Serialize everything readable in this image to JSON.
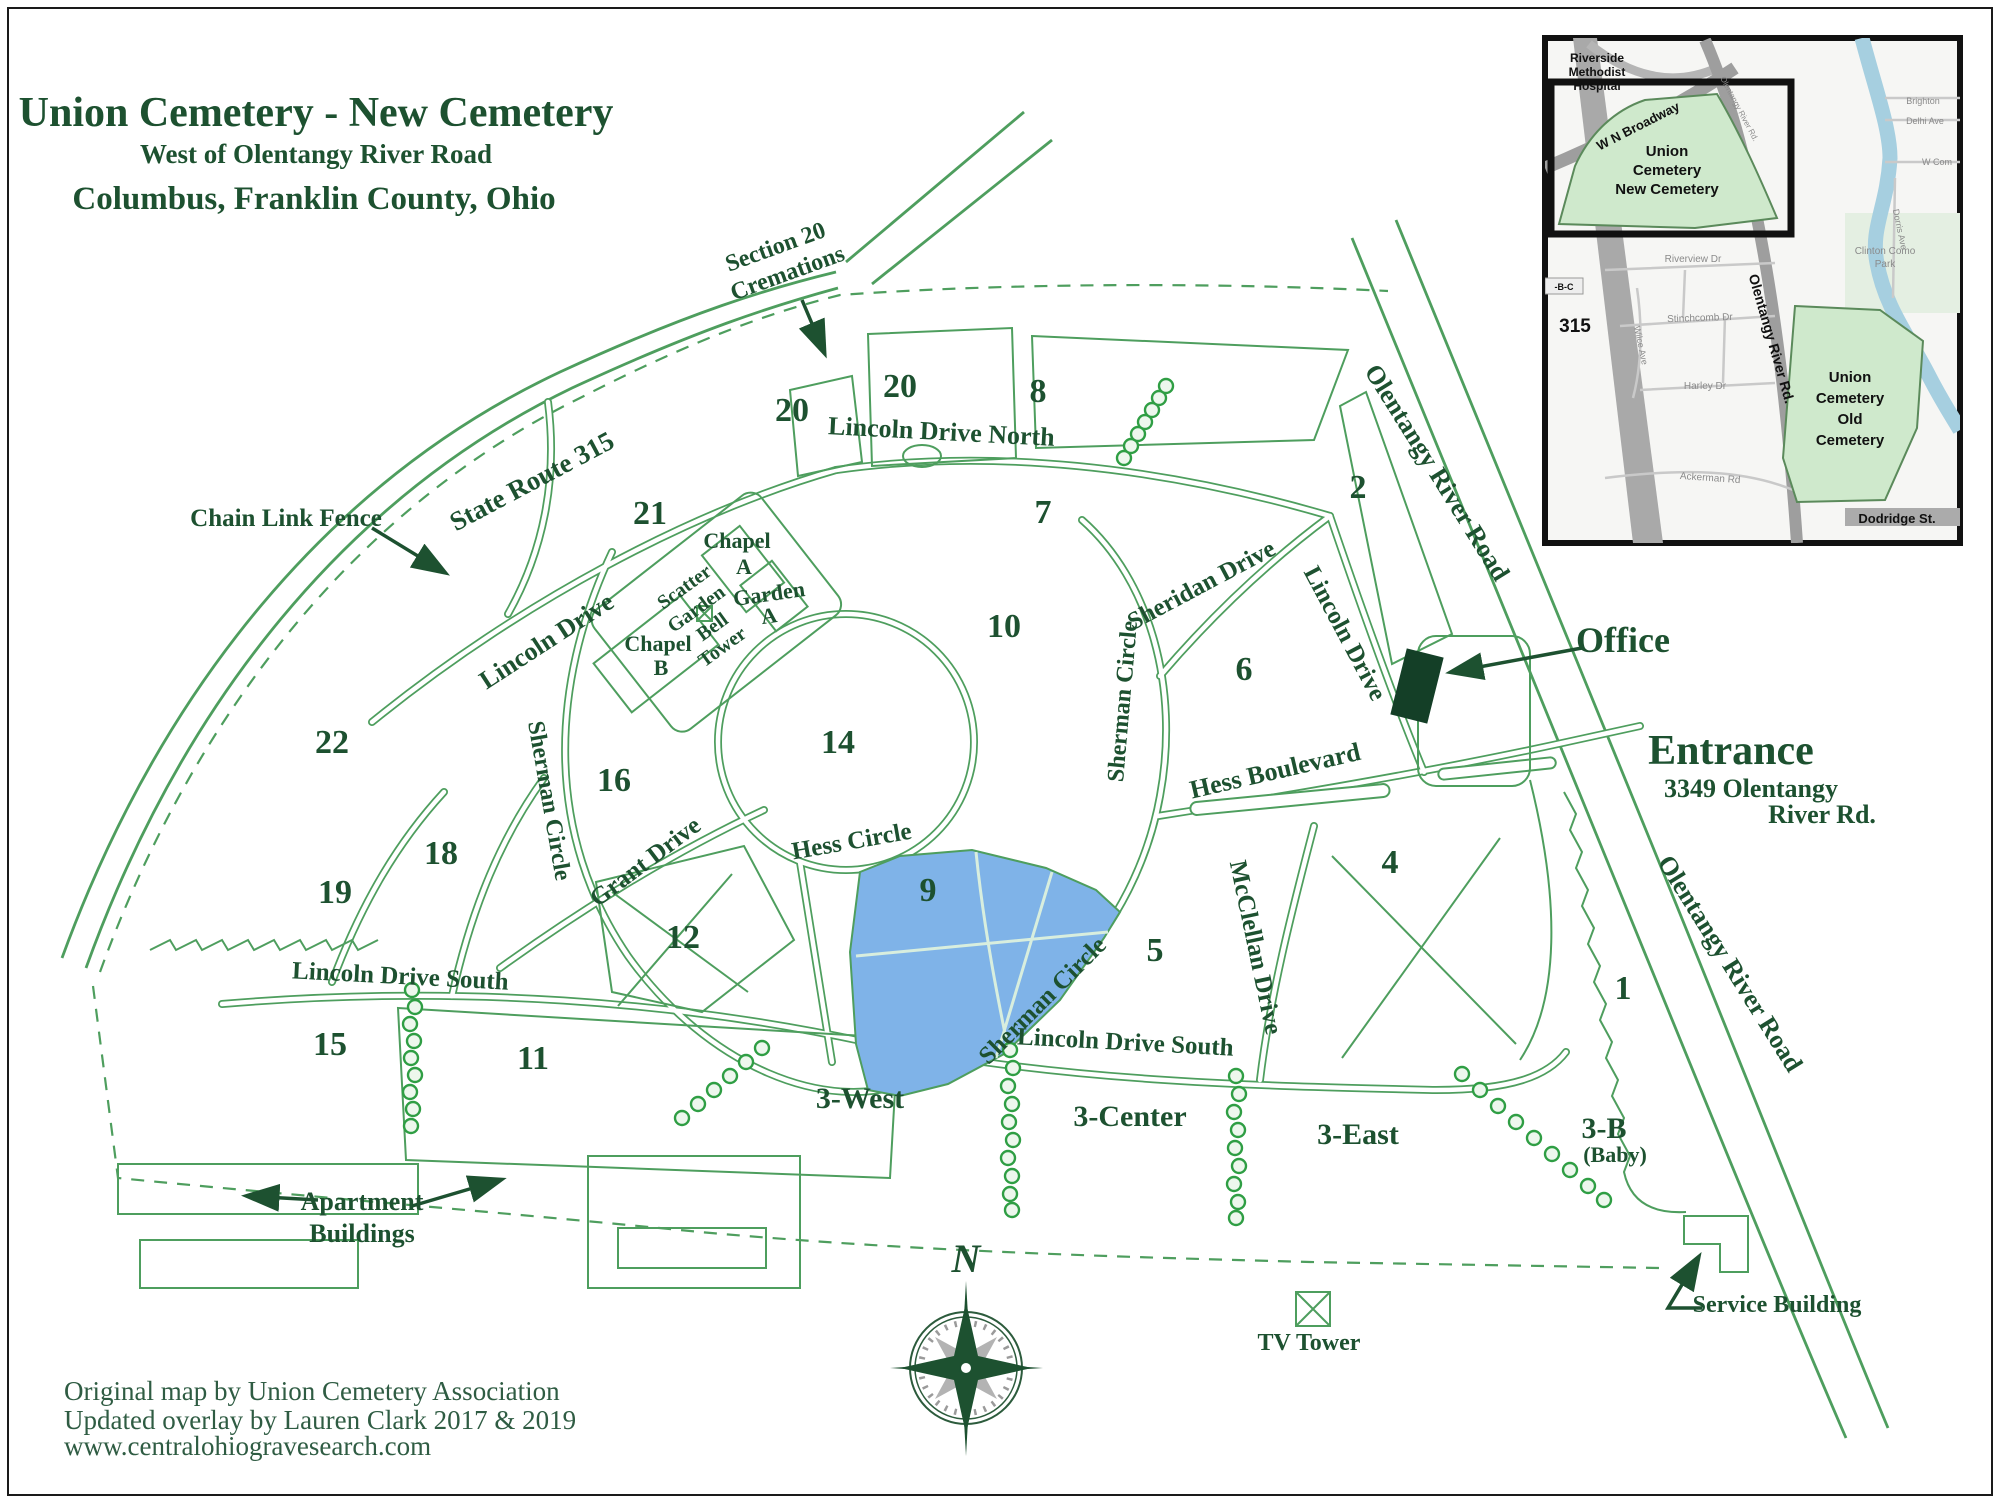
{
  "title": {
    "line1": "Union Cemetery - New Cemetery",
    "line2": "West of Olentangy River Road",
    "line3": "Columbus, Franklin County, Ohio"
  },
  "credits": {
    "line1": "Original map by Union Cemetery Association",
    "line2": "Updated overlay by Lauren Clark 2017 & 2019",
    "line3": "www.centralohiogravesearch.com"
  },
  "compass": {
    "north": "N"
  },
  "colors": {
    "road_green": "#4e9e5e",
    "label_green": "#1d5130",
    "section9_blue": "#7fb3e8",
    "tree_green": "#2f9e44",
    "office_fill": "#143f27",
    "inset_cemetery_green": "#cfe9cc",
    "inset_river_blue": "#a6cfe0"
  },
  "roads": {
    "state_route_315": "State Route 315",
    "lincoln_drive_north": "Lincoln Drive North",
    "lincoln_drive": "Lincoln Drive",
    "sheridan_drive": "Sheridan Drive",
    "sherman_circle": "Sherman Circle",
    "hess_circle": "Hess Circle",
    "hess_boulevard": "Hess Boulevard",
    "grant_drive": "Grant Drive",
    "lincoln_drive_south": "Lincoln Drive South",
    "mcclellan_drive": "McClellan Drive",
    "olentangy_river_road": "Olentangy River Road"
  },
  "sections": {
    "s1": "1",
    "s2": "2",
    "s4": "4",
    "s5": "5",
    "s6": "6",
    "s7": "7",
    "s8": "8",
    "s9": "9",
    "s10": "10",
    "s11": "11",
    "s12": "12",
    "s14": "14",
    "s15": "15",
    "s16": "16",
    "s18": "18",
    "s19": "19",
    "s20a": "20",
    "s20b": "20",
    "s21": "21",
    "s22": "22",
    "z3_west": "3-West",
    "z3_center": "3-Center",
    "z3_east": "3-East",
    "z3b": "3-B",
    "z3b_sub": "(Baby)"
  },
  "landmarks": {
    "section20_cremations": [
      "Section 20",
      "Cremations"
    ],
    "chain_link_fence": "Chain Link Fence",
    "chapel_a": [
      "Chapel",
      "A"
    ],
    "chapel_b": [
      "Chapel",
      "B"
    ],
    "scatter_garden": [
      "Scatter",
      "Garden"
    ],
    "garden_a": [
      "Garden",
      "A"
    ],
    "bell_tower": [
      "Bell",
      "Tower"
    ],
    "office": "Office",
    "entrance": "Entrance",
    "entrance_address": [
      "3349 Olentangy",
      "River Rd."
    ],
    "apartment_buildings": [
      "Apartment",
      "Buildings"
    ],
    "service_building": "Service Building",
    "tv_tower": "TV Tower"
  },
  "inset": {
    "hospital": [
      "Riverside",
      "Methodist",
      "Hospital"
    ],
    "w_n_broadway": "W N Broadway",
    "new_cemetery": [
      "Union",
      "Cemetery",
      "New Cemetery"
    ],
    "old_cemetery": [
      "Union",
      "Cemetery",
      "Old",
      "Cemetery"
    ],
    "olentangy_river_rd": "Olentangy River Rd.",
    "route_315": "315",
    "route_bc": "-B-C",
    "riverview_dr": "Riverview Dr",
    "stinchcomb_dr": "Stinchcomb Dr",
    "wilce_ave": "Wilce Ave",
    "harley_dr": "Harley Dr",
    "ackerman_rd": "Ackerman Rd",
    "dodridge_st": "Dodridge St.",
    "clinton_como_park": [
      "Clinton Como",
      "Park"
    ],
    "brighton": "Brighton",
    "delhi_ave": "Delhi Ave",
    "w_com": "W Com",
    "dorris_ave": "Dorris Ave"
  }
}
